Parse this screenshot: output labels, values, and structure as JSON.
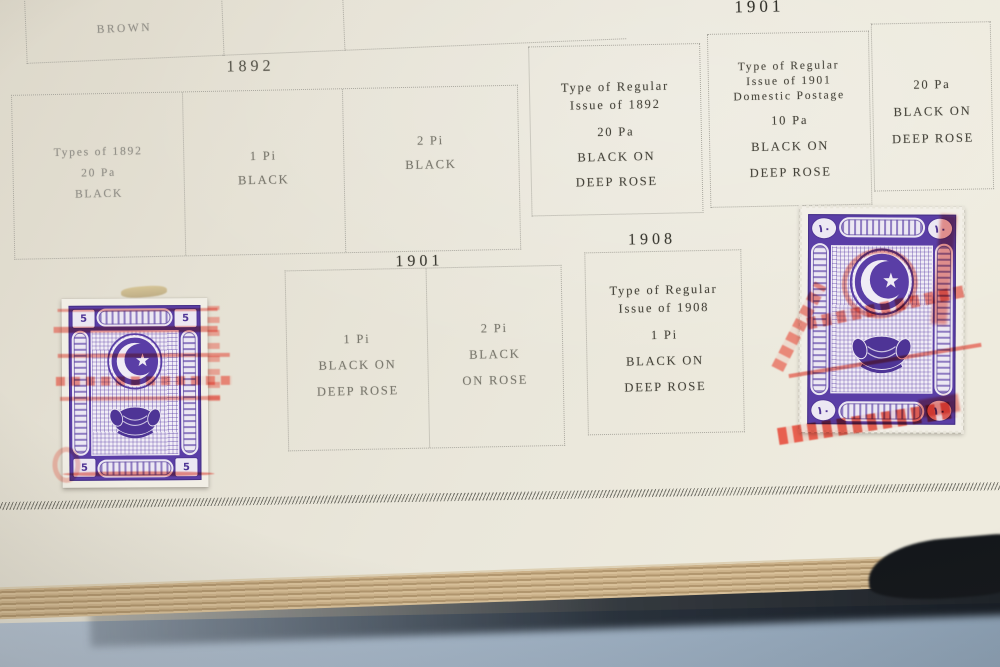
{
  "headers": {
    "y1892": "1892",
    "y1901_top": "1901",
    "y1901_mid": "1901",
    "y1908": "1908"
  },
  "boxes": {
    "brown": {
      "lines": [
        "BROWN"
      ]
    },
    "types1892": {
      "lines": [
        "Types of 1892",
        "20 Pa",
        "BLACK"
      ]
    },
    "onePiBlack": {
      "lines": [
        "1 Pi",
        "BLACK"
      ]
    },
    "twoPiBlack": {
      "lines": [
        "2 Pi",
        "BLACK"
      ]
    },
    "regular1892": {
      "lines": [
        "Type of Regular",
        "Issue of 1892",
        "20 Pa",
        "BLACK ON",
        "DEEP ROSE"
      ]
    },
    "regular1901": {
      "lines": [
        "Type of Regular",
        "Issue of 1901",
        "Domestic Postage",
        "10 Pa",
        "BLACK ON",
        "DEEP ROSE"
      ]
    },
    "twentyPaRose": {
      "lines": [
        "20 Pa",
        "BLACK ON",
        "DEEP ROSE"
      ]
    },
    "onePiRose": {
      "lines": [
        "1 Pi",
        "BLACK ON",
        "DEEP ROSE"
      ]
    },
    "twoPiRose": {
      "lines": [
        "2 Pi",
        "BLACK",
        "ON ROSE"
      ]
    },
    "regular1908": {
      "lines": [
        "Type of Regular",
        "Issue of 1908",
        "1 Pi",
        "BLACK ON",
        "DEEP ROSE"
      ]
    }
  },
  "stamps": {
    "left": {
      "corner_value": "5"
    },
    "right": {
      "corner_value": "١٠"
    }
  },
  "colors": {
    "page": "#e9e6da",
    "box_border": "#aaa89f",
    "stamp_violet": "#5a3ea6",
    "overprint_red": "#e23728",
    "page_edge_tan": "#c2a87e",
    "table_blue": "#a3b5c9",
    "shadow_dark": "#14171b"
  }
}
